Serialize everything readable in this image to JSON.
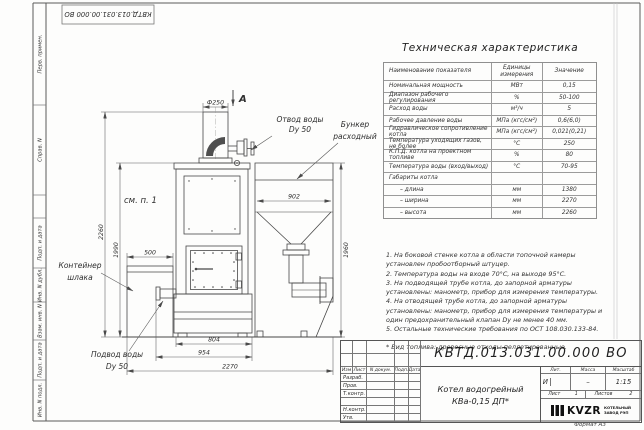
{
  "sheet": {
    "doc_number_rotated": "КВТД.013.031.00.000 ВО",
    "format_label": "Формат А3",
    "left_strip": [
      "Перв. примен.",
      "Справ. N",
      "Подп. и дата",
      "Инв. N дубл.",
      "Взам. инв. N",
      "Подп. и дата",
      "Инв. N подл."
    ]
  },
  "drawing": {
    "view_label": "А",
    "see_note": "см. п. 1",
    "callouts": {
      "water_outlet_line1": "Отвод воды",
      "water_outlet_line2": "Dу 50",
      "bunker_line1": "Бункер",
      "bunker_line2": "расходный",
      "slag_line1": "Контейнер",
      "slag_line2": "шлака",
      "water_inlet_line1": "Подвод воды",
      "water_inlet_line2": "Dу 50"
    },
    "dims": {
      "chimney": "Ф250",
      "h_total": "2260",
      "h_body": "1990",
      "w_slag": "500",
      "w_bunker_in": "902",
      "h_bunker": "1960",
      "w_base": "804",
      "w_mid": "954",
      "w_total": "2270"
    }
  },
  "spec_table": {
    "title": "Техническая характеристика",
    "headers": [
      "Наименование показателя",
      "Единицы измерения",
      "Значение"
    ],
    "rows": [
      [
        "Номинальная мощность",
        "МВт",
        "0,15"
      ],
      [
        "Диапазон рабочего регулирования",
        "%",
        "50-100"
      ],
      [
        "Расход воды",
        "м³/ч",
        "5"
      ],
      [
        "Рабочее давление воды",
        "МПа (кгс/см²)",
        "0,6(6,0)"
      ],
      [
        "Гидравлическое сопротивление котла",
        "МПа (кгс/см²)",
        "0,021(0,21)"
      ],
      [
        "Температура уходящих газов, не более",
        "°С",
        "250"
      ],
      [
        "К.П.Д. котла на проектном топливе",
        "%",
        "80"
      ],
      [
        "Температура воды (вход/выход)",
        "°С",
        "70-95"
      ],
      [
        "Габариты котла",
        "",
        ""
      ],
      [
        "– длина",
        "мм",
        "1380"
      ],
      [
        "– ширина",
        "мм",
        "2270"
      ],
      [
        "– высота",
        "мм",
        "2260"
      ]
    ]
  },
  "notes": [
    "1. На боковой стенке котла в области топочной камеры установлен пробоотборный штуцер.",
    "2. Температура воды на входе 70°С, на выходе 95°С.",
    "3. На подводящей трубе котла, до запорной арматуры установлены: манометр, прибор для измерения температуры.",
    "4. На отводящей трубе котла, до запорной арматуры установлены: манометр, прибор для измерения температуры и один предохранительный клапан Dу не менее 40 мм.",
    "5. Остальные технические требования по ОСТ 108.030.133-84."
  ],
  "fuel_note": "* Вид топлива: древесные отходы пеллетированные.",
  "title_block": {
    "designation": "КВТД.013.031.00.000 ВО",
    "rev_header": [
      "Изм",
      "Лист",
      "N докум.",
      "Подп.",
      "Дата"
    ],
    "sign_rows": [
      "Разраб.",
      "Пров.",
      "Т.контр.",
      "",
      "Н.контр.",
      "Утв."
    ],
    "product_name_line1": "Котел водогрейный",
    "product_name_line2": "КВа-0,15 ДП*",
    "lit_header": "Лит.",
    "mass_header": "Масса",
    "scale_header": "Масштаб",
    "lit_value": "И",
    "mass_value": "–",
    "scale_value": "1:15",
    "sheet_label": "Лист",
    "sheet_value": "1",
    "sheets_label": "Листов",
    "sheets_value": "2",
    "logo_text": "KVZR",
    "logo_sub_line1": "КОТЕЛЬНЫЙ",
    "logo_sub_line2": "ЗАВОД РЭП"
  }
}
